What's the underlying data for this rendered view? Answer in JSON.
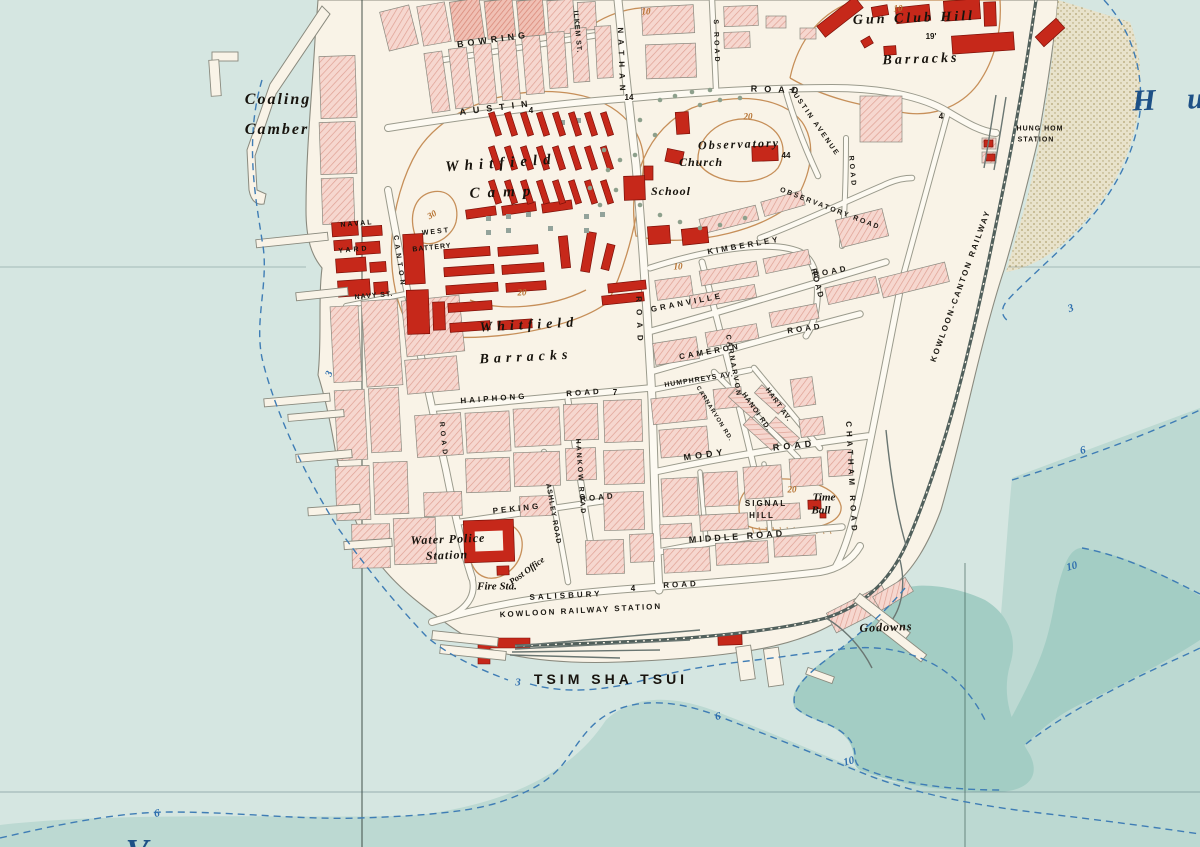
{
  "map": {
    "description": "Historic plan of Tsim Sha Tsui, Kowloon peninsula, with Victoria Harbour and Hung Hom Bay",
    "district_name": "TSIM SHA TSUI"
  },
  "palette": {
    "water_shallow": "#d5e6e1",
    "water_mid": "#bcd9d2",
    "water_deep": "#a3cdc4",
    "land": "#f9f3e7",
    "block_pink": "#f6d7cf",
    "block_hatch_line": "#dfa093",
    "building_red": "#c6281a",
    "contour_orange": "#c48a52",
    "contour_orange_text": "#b5702f",
    "depth_blue": "#3f7db5",
    "depth_blue_text": "#2f6fae",
    "railway": "#51605c",
    "label_water_blue": "#1d5086",
    "mudflat": "#eae2c8"
  },
  "labels": [
    {
      "k": "street",
      "t": "BOWRING",
      "x": 493,
      "y": 40,
      "r": -8,
      "s": 9,
      "ls": 4
    },
    {
      "k": "street",
      "t": "ILKEM ST.",
      "x": 577,
      "y": 32,
      "r": 85,
      "s": 7,
      "ls": 1
    },
    {
      "k": "street",
      "t": "NATHAN",
      "x": 621,
      "y": 62,
      "r": 88,
      "s": 8,
      "ls": 6
    },
    {
      "k": "street",
      "t": "ROAD",
      "x": 639,
      "y": 322,
      "r": 88,
      "s": 8,
      "ls": 7
    },
    {
      "k": "street",
      "t": "S ROAD",
      "x": 716,
      "y": 42,
      "r": 88,
      "s": 7,
      "ls": 3
    },
    {
      "k": "street",
      "t": "AUSTIN",
      "x": 497,
      "y": 108,
      "r": -7,
      "s": 9,
      "ls": 7
    },
    {
      "k": "street",
      "t": "ROAD",
      "x": 778,
      "y": 90,
      "r": 2,
      "s": 9,
      "ls": 7
    },
    {
      "k": "street",
      "t": "AUSTIN AVENUE",
      "x": 814,
      "y": 122,
      "r": 55,
      "s": 7,
      "ls": 2
    },
    {
      "k": "street",
      "t": "OBSERVATORY ROAD",
      "x": 830,
      "y": 209,
      "r": 21,
      "s": 7,
      "ls": 2
    },
    {
      "k": "street",
      "t": "KIMBERLEY",
      "x": 744,
      "y": 246,
      "r": -10,
      "s": 8,
      "ls": 3
    },
    {
      "k": "street",
      "t": "ROAD",
      "x": 817,
      "y": 284,
      "r": 75,
      "s": 8,
      "ls": 2
    },
    {
      "k": "street",
      "t": "GRANVILLE",
      "x": 687,
      "y": 303,
      "r": -11,
      "s": 8,
      "ls": 3
    },
    {
      "k": "street",
      "t": "ROAD",
      "x": 831,
      "y": 272,
      "r": -11,
      "s": 8,
      "ls": 3
    },
    {
      "k": "street",
      "t": "CAMERON",
      "x": 710,
      "y": 352,
      "r": -10,
      "s": 8,
      "ls": 3
    },
    {
      "k": "street",
      "t": "ROAD",
      "x": 805,
      "y": 329,
      "r": -8,
      "s": 8,
      "ls": 3
    },
    {
      "k": "street",
      "t": "CARNARVON",
      "x": 733,
      "y": 366,
      "r": 80,
      "s": 7,
      "ls": 2
    },
    {
      "k": "street",
      "t": "CARNARVON RD.",
      "x": 714,
      "y": 414,
      "r": 58,
      "s": 6,
      "ls": 1
    },
    {
      "k": "street",
      "t": "HANOI RD.",
      "x": 756,
      "y": 412,
      "r": 55,
      "s": 7,
      "ls": 1
    },
    {
      "k": "street",
      "t": "HART AV.",
      "x": 778,
      "y": 405,
      "r": 55,
      "s": 7,
      "ls": 1
    },
    {
      "k": "street",
      "t": "HUMPHREYS AV.",
      "x": 699,
      "y": 380,
      "r": -9,
      "s": 7,
      "ls": 1
    },
    {
      "k": "street",
      "t": "MODY",
      "x": 705,
      "y": 455,
      "r": -8,
      "s": 9,
      "ls": 4
    },
    {
      "k": "street",
      "t": "ROAD",
      "x": 794,
      "y": 446,
      "r": -6,
      "s": 9,
      "ls": 4
    },
    {
      "k": "street",
      "t": "MIDDLE ROAD",
      "x": 737,
      "y": 537,
      "r": -4,
      "s": 9,
      "ls": 3
    },
    {
      "k": "street",
      "t": "CHATHAM ROAD",
      "x": 851,
      "y": 478,
      "r": 87,
      "s": 8,
      "ls": 4
    },
    {
      "k": "street",
      "t": "HAIPHONG",
      "x": 494,
      "y": 399,
      "r": -4,
      "s": 8,
      "ls": 3
    },
    {
      "k": "street",
      "t": "ROAD",
      "x": 584,
      "y": 393,
      "r": -4,
      "s": 8,
      "ls": 3
    },
    {
      "k": "street",
      "t": "HANKOW ROAD",
      "x": 580,
      "y": 477,
      "r": 86,
      "s": 7,
      "ls": 2
    },
    {
      "k": "street",
      "t": "ASHLEY ROAD",
      "x": 553,
      "y": 514,
      "r": 80,
      "s": 7,
      "ls": 1
    },
    {
      "k": "street",
      "t": "PEKING",
      "x": 517,
      "y": 509,
      "r": -6,
      "s": 8,
      "ls": 3
    },
    {
      "k": "street",
      "t": "ROAD",
      "x": 598,
      "y": 498,
      "r": -6,
      "s": 8,
      "ls": 3
    },
    {
      "k": "street",
      "t": "SALISBURY",
      "x": 566,
      "y": 596,
      "r": -3,
      "s": 8,
      "ls": 3
    },
    {
      "k": "street",
      "t": "ROAD",
      "x": 681,
      "y": 585,
      "r": -3,
      "s": 8,
      "ls": 3
    },
    {
      "k": "street",
      "t": "KOWLOON RAILWAY STATION",
      "x": 581,
      "y": 611,
      "r": -3,
      "s": 8,
      "ls": 2
    },
    {
      "k": "street",
      "t": "NAVY ST.",
      "x": 374,
      "y": 296,
      "r": -5,
      "s": 7,
      "ls": 1
    },
    {
      "k": "street",
      "t": "CANTON",
      "x": 399,
      "y": 262,
      "r": 82,
      "s": 7,
      "ls": 4
    },
    {
      "k": "street",
      "t": "ROAD",
      "x": 443,
      "y": 440,
      "r": 84,
      "s": 7,
      "ls": 4
    },
    {
      "k": "street",
      "t": "ROAD",
      "x": 852,
      "y": 172,
      "r": 85,
      "s": 7,
      "ls": 3
    },
    {
      "k": "street",
      "t": "KOWLOON-CANTON RAILWAY",
      "x": 961,
      "y": 286,
      "r": -70,
      "s": 8,
      "ls": 2
    },
    {
      "k": "place",
      "t": "Coaling",
      "x": 278,
      "y": 100,
      "r": 0,
      "s": 16,
      "ls": 2
    },
    {
      "k": "place",
      "t": "Camber",
      "x": 277,
      "y": 130,
      "r": 0,
      "s": 16,
      "ls": 2
    },
    {
      "k": "place",
      "t": "Whitfield",
      "x": 501,
      "y": 164,
      "r": -4,
      "s": 15,
      "ls": 6
    },
    {
      "k": "place",
      "t": "Camp",
      "x": 504,
      "y": 193,
      "r": -2,
      "s": 15,
      "ls": 8
    },
    {
      "k": "place",
      "t": "Whitfield",
      "x": 529,
      "y": 326,
      "r": -3,
      "s": 14,
      "ls": 5
    },
    {
      "k": "place",
      "t": "Barracks",
      "x": 526,
      "y": 358,
      "r": -3,
      "s": 14,
      "ls": 5
    },
    {
      "k": "place",
      "t": "Gun Club Hill",
      "x": 914,
      "y": 19,
      "r": -2,
      "s": 14,
      "ls": 3
    },
    {
      "k": "place",
      "t": "Barracks",
      "x": 921,
      "y": 60,
      "r": -2,
      "s": 14,
      "ls": 3
    },
    {
      "k": "place",
      "t": "Observatory",
      "x": 739,
      "y": 144,
      "r": -2,
      "s": 12,
      "ls": 2
    },
    {
      "k": "place",
      "t": "Church",
      "x": 701,
      "y": 162,
      "r": 0,
      "s": 12,
      "ls": 1
    },
    {
      "k": "place",
      "t": "School",
      "x": 671,
      "y": 191,
      "r": 0,
      "s": 12,
      "ls": 1
    },
    {
      "k": "place",
      "t": "Water Police",
      "x": 448,
      "y": 539,
      "r": -2,
      "s": 12,
      "ls": 1
    },
    {
      "k": "place",
      "t": "Station",
      "x": 447,
      "y": 555,
      "r": -2,
      "s": 12,
      "ls": 1
    },
    {
      "k": "place",
      "t": "Post Office",
      "x": 527,
      "y": 571,
      "r": -36,
      "s": 9,
      "ls": 0
    },
    {
      "k": "place",
      "t": "Fire Sta.",
      "x": 497,
      "y": 587,
      "r": 0,
      "s": 11,
      "ls": 0
    },
    {
      "k": "place",
      "t": "Time",
      "x": 824,
      "y": 498,
      "r": 0,
      "s": 11,
      "ls": 0
    },
    {
      "k": "place",
      "t": "Ball",
      "x": 821,
      "y": 511,
      "r": 0,
      "s": 11,
      "ls": 0
    },
    {
      "k": "place",
      "t": "Godowns",
      "x": 886,
      "y": 627,
      "r": -2,
      "s": 12,
      "ls": 1
    },
    {
      "k": "caps",
      "t": "NAVAL",
      "x": 357,
      "y": 224,
      "r": -5,
      "s": 7,
      "ls": 2
    },
    {
      "k": "caps",
      "t": "YARD",
      "x": 354,
      "y": 250,
      "r": -5,
      "s": 7,
      "ls": 3
    },
    {
      "k": "caps",
      "t": "WEST",
      "x": 436,
      "y": 232,
      "r": -6,
      "s": 7,
      "ls": 2
    },
    {
      "k": "caps",
      "t": "BATTERY",
      "x": 432,
      "y": 248,
      "r": -6,
      "s": 7,
      "ls": 1
    },
    {
      "k": "caps",
      "t": "SIGNAL",
      "x": 766,
      "y": 504,
      "r": 0,
      "s": 8,
      "ls": 2
    },
    {
      "k": "caps",
      "t": "HILL",
      "x": 762,
      "y": 516,
      "r": 0,
      "s": 8,
      "ls": 2
    },
    {
      "k": "caps",
      "t": "TSIM SHA TSUI",
      "x": 611,
      "y": 679,
      "r": 0,
      "s": 14,
      "ls": 4
    },
    {
      "k": "caps",
      "t": "HUNG HOM",
      "x": 1040,
      "y": 129,
      "r": 0,
      "s": 7,
      "ls": 1
    },
    {
      "k": "caps",
      "t": "STATION",
      "x": 1036,
      "y": 140,
      "r": 0,
      "s": 7,
      "ls": 1
    },
    {
      "k": "water",
      "t": "H u",
      "x": 1174,
      "y": 100,
      "r": -2,
      "s": 30,
      "ls": 12
    },
    {
      "k": "water",
      "t": "V",
      "x": 137,
      "y": 852,
      "r": 0,
      "s": 34,
      "ls": 0
    },
    {
      "k": "contour",
      "t": "30",
      "x": 432,
      "y": 215,
      "r": -30,
      "s": 9
    },
    {
      "k": "contour",
      "t": "20",
      "x": 522,
      "y": 293,
      "r": 0,
      "s": 9
    },
    {
      "k": "contour",
      "t": "20",
      "x": 748,
      "y": 117,
      "r": 0,
      "s": 9
    },
    {
      "k": "contour",
      "t": "20",
      "x": 792,
      "y": 490,
      "r": 0,
      "s": 9
    },
    {
      "k": "contour",
      "t": "10",
      "x": 646,
      "y": 12,
      "r": 0,
      "s": 9
    },
    {
      "k": "contour",
      "t": "10",
      "x": 898,
      "y": 9,
      "r": 0,
      "s": 9
    },
    {
      "k": "contour",
      "t": "10",
      "x": 678,
      "y": 267,
      "r": 0,
      "s": 9
    },
    {
      "k": "depth",
      "t": "3",
      "x": 330,
      "y": 374,
      "r": -70,
      "s": 10
    },
    {
      "k": "depth",
      "t": "3",
      "x": 518,
      "y": 683,
      "r": 0,
      "s": 11
    },
    {
      "k": "depth",
      "t": "6",
      "x": 718,
      "y": 717,
      "r": -10,
      "s": 11
    },
    {
      "k": "depth",
      "t": "10",
      "x": 849,
      "y": 762,
      "r": -15,
      "s": 11
    },
    {
      "k": "depth",
      "t": "6",
      "x": 157,
      "y": 814,
      "r": -10,
      "s": 11
    },
    {
      "k": "depth",
      "t": "3",
      "x": 1071,
      "y": 309,
      "r": -20,
      "s": 11
    },
    {
      "k": "depth",
      "t": "6",
      "x": 1083,
      "y": 451,
      "r": -15,
      "s": 11
    },
    {
      "k": "depth",
      "t": "10",
      "x": 1072,
      "y": 567,
      "r": -15,
      "s": 11
    },
    {
      "k": "spot",
      "t": "4",
      "x": 531,
      "y": 111,
      "r": 0,
      "s": 8
    },
    {
      "k": "spot",
      "t": "14",
      "x": 629,
      "y": 98,
      "r": 0,
      "s": 8
    },
    {
      "k": "spot",
      "t": "4",
      "x": 941,
      "y": 117,
      "r": 0,
      "s": 8
    },
    {
      "k": "spot",
      "t": "19'",
      "x": 931,
      "y": 37,
      "r": 0,
      "s": 8
    },
    {
      "k": "spot",
      "t": "44",
      "x": 786,
      "y": 156,
      "r": 0,
      "s": 8
    },
    {
      "k": "spot",
      "t": "7",
      "x": 615,
      "y": 393,
      "r": 0,
      "s": 8
    },
    {
      "k": "spot",
      "t": "4",
      "x": 633,
      "y": 589,
      "r": 0,
      "s": 8
    }
  ]
}
